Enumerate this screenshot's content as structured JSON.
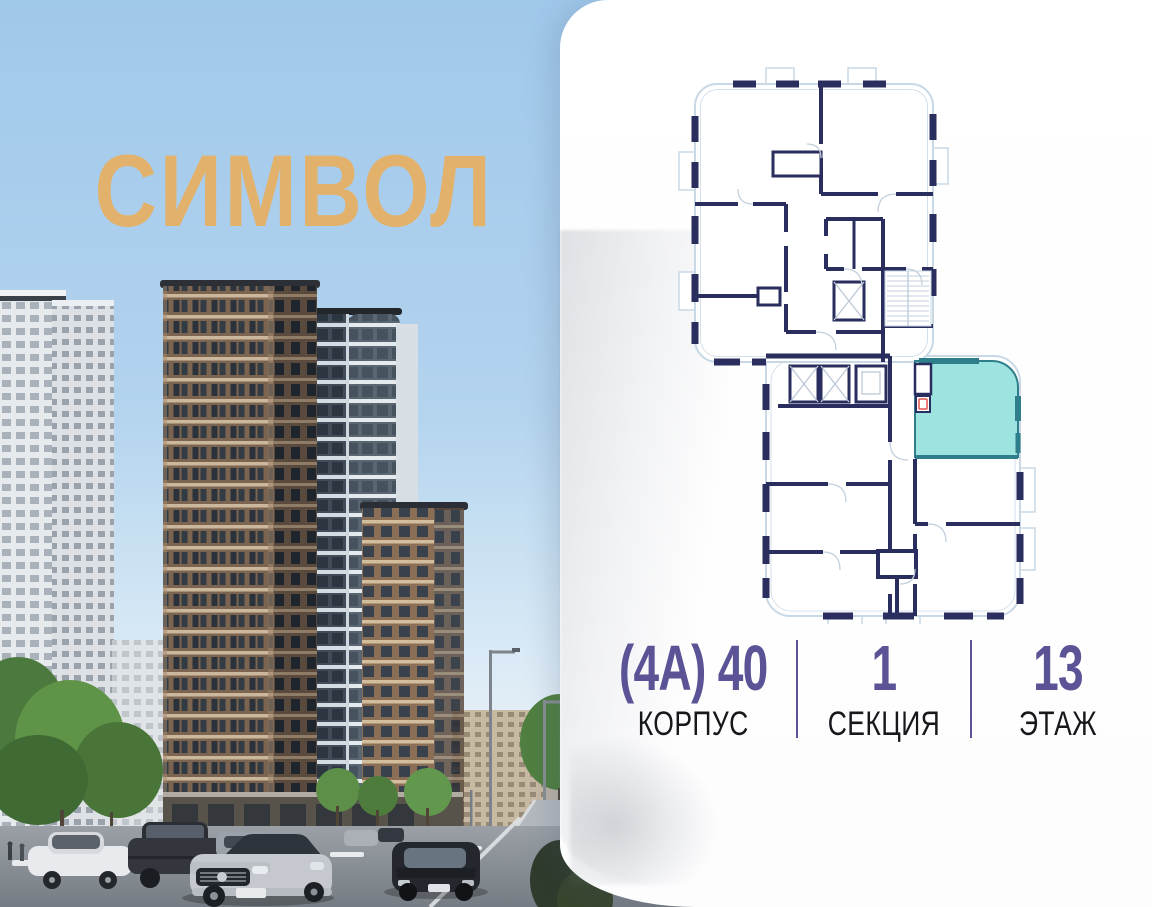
{
  "brand": {
    "logo_text": "СИМВОЛ",
    "logo_color": "#e2b26c"
  },
  "card": {
    "info": {
      "building": {
        "value": "(4А) 40",
        "label": "КОРПУС"
      },
      "section": {
        "value": "1",
        "label": "СЕКЦИЯ"
      },
      "floor": {
        "value": "13",
        "label": "ЭТАЖ"
      }
    },
    "accent_color": "#5a5496",
    "label_color": "#17181c"
  },
  "floor_plan": {
    "wall_color": "#2a2e5e",
    "outline_color": "#c9d8e5",
    "highlight_fill": "#9de4e0",
    "highlight_border": "#2e7f8b",
    "fixture_marker_color": "#e0524f"
  },
  "scene": {
    "sky_top": "#a0c8eb",
    "sky_bottom": "#eef5f9",
    "tower_brown": "#7b6450",
    "tower_glass": "#414c58"
  }
}
